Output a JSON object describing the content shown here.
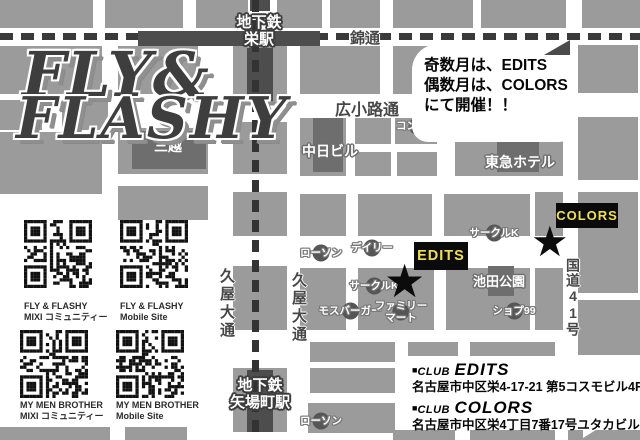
{
  "logo": {
    "line1": "FLY&",
    "line2": "FLASHY"
  },
  "notice": {
    "line1": "奇数月は、EDITS",
    "line2": "偶数月は、COLORS",
    "line3": "にて開催！！"
  },
  "stations": {
    "sakae": {
      "line1": "地下鉄",
      "line2": "栄駅"
    },
    "yabacho": {
      "line1": "地下鉄",
      "line2": "矢場町駅"
    }
  },
  "streets": {
    "nishiki": "錦通",
    "hirokoji": "広小路通",
    "hisaya_left": "久屋大通",
    "hisaya_right": "久屋大通",
    "route41": "国道41号"
  },
  "buildings": {
    "mitsukoshi": "三越",
    "chunichi": "中日ビル",
    "tokyu": "東急ホテル",
    "ikeda_park": "池田公園"
  },
  "stores": {
    "conbini": "コンビニ",
    "lawson_top": "ローソン",
    "daily": "デイリー",
    "circlek_top": "サークルK",
    "circlek_mid": "サークルK",
    "mos": "モスバーガー",
    "family_line1": "ファミリー",
    "family_line2": "マート",
    "shop99": "ショプ99",
    "lawson_bottom": "ローソン"
  },
  "venues": {
    "edits": {
      "label": "EDITS"
    },
    "colors": {
      "label": "COLORS"
    }
  },
  "qr": [
    {
      "title": "FLY & FLASHY",
      "subtitle": "MIXI コミュニティー"
    },
    {
      "title": "FLY & FLASHY",
      "subtitle": "Mobile Site"
    },
    {
      "title": "MY MEN BROTHER",
      "subtitle": "MIXI コミュニティー"
    },
    {
      "title": "MY MEN BROTHER",
      "subtitle": "Mobile Site"
    }
  ],
  "addresses": {
    "edits": {
      "bullet": "■",
      "club": "CLUB",
      "name": "EDITS",
      "address": "名古屋市中区栄4-17-21 第5コスモビル4F"
    },
    "colors": {
      "bullet": "■",
      "club": "CLUB",
      "name": "COLORS",
      "address": "名古屋市中区栄4丁目7番17号ユタカビル3F"
    }
  },
  "palette": {
    "city_block": "#9b9b9b",
    "dark_building": "#6e6e6e",
    "station": "#4d4d4d",
    "rail_dash": "#3a3a3a",
    "venue_box_bg": "#0b0b0b",
    "venue_text_yellow": "#f0e050"
  }
}
